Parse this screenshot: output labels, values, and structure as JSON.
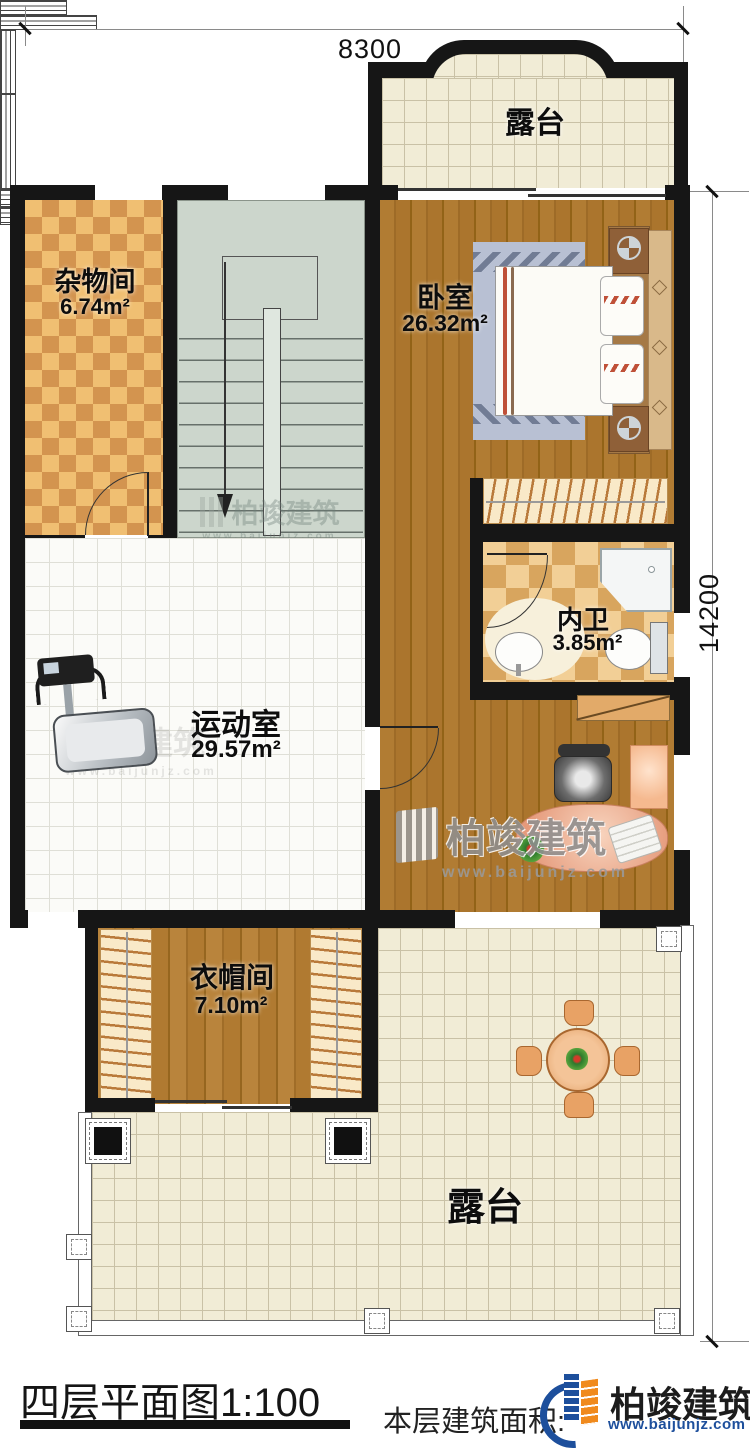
{
  "dims": {
    "top": "8300",
    "right": "14200"
  },
  "rooms": {
    "terrace_top": {
      "name": "露台"
    },
    "storage": {
      "name": "杂物间",
      "area": "6.74m²"
    },
    "bedroom": {
      "name": "卧室",
      "area": "26.32m²"
    },
    "bathroom": {
      "name": "内卫",
      "area": "3.85m²"
    },
    "gym": {
      "name": "运动室",
      "area": "29.57m²"
    },
    "cloakroom": {
      "name": "衣帽间",
      "area": "7.10m²"
    },
    "terrace_bottom": {
      "name": "露台"
    }
  },
  "watermark": {
    "brand": "柏竣建筑",
    "site": "www.baijunjz.com"
  },
  "footer": {
    "title": "四层平面图1:100",
    "area_note": "本层建筑面积:",
    "brand": "柏竣建筑",
    "site": "www.baijunjz.com"
  },
  "colors": {
    "logo_blue": "#1d4f9c",
    "logo_orange": "#f08a1d",
    "wall": "#161616"
  }
}
